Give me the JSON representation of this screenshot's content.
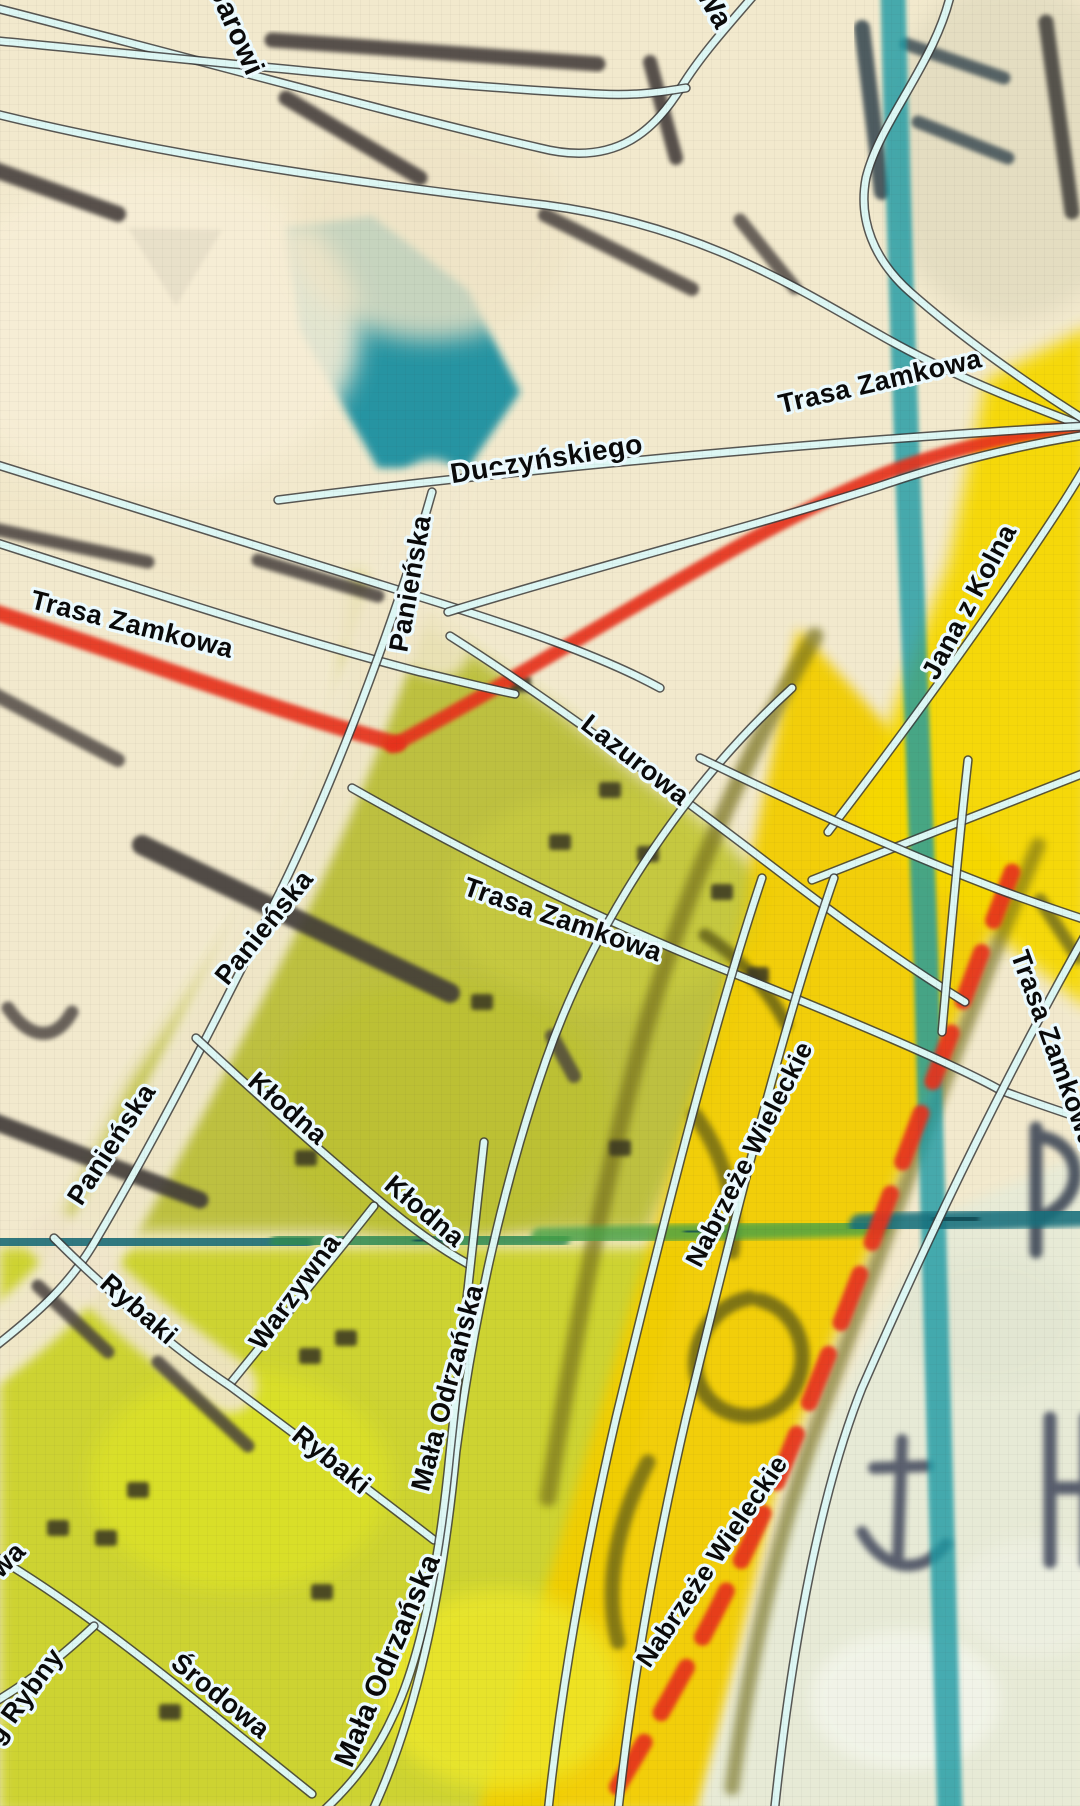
{
  "map": {
    "colors": {
      "background_cream": "#f2e9cd",
      "road_fill": "#ddf7f4",
      "road_casing": "#3c3c3c",
      "label_ink": "#0a0a0a",
      "label_halo": "#edfbff",
      "raster_red": "#e6301a",
      "raster_teal": "#1b9aa4",
      "raster_olive": "#b9bd36",
      "raster_yellow": "#f2cd02"
    },
    "street_labels": [
      {
        "text": "Jarowi",
        "x": 228,
        "y": 34,
        "rot": 66,
        "size": 29
      },
      {
        "text": "Wa",
        "x": 706,
        "y": 12,
        "rot": 60,
        "size": 29
      },
      {
        "text": "Trasa Zamkowa",
        "x": 882,
        "y": 390,
        "rot": -13,
        "size": 27
      },
      {
        "text": "Duczyńskiego",
        "x": 548,
        "y": 468,
        "rot": -9,
        "size": 28
      },
      {
        "text": "–",
        "x": 500,
        "y": 481,
        "rot": -6,
        "size": 28
      },
      {
        "text": "Panieńska",
        "x": 419,
        "y": 585,
        "rot": -80,
        "size": 27
      },
      {
        "text": "Trasa Zamkowa",
        "x": 130,
        "y": 633,
        "rot": 14,
        "size": 27
      },
      {
        "text": "Lazurowa",
        "x": 630,
        "y": 767,
        "rot": 38,
        "size": 27
      },
      {
        "text": "Jana z Kolna",
        "x": 977,
        "y": 606,
        "rot": -62,
        "size": 27
      },
      {
        "text": "Panieńska",
        "x": 271,
        "y": 933,
        "rot": -51,
        "size": 27
      },
      {
        "text": "Trasa Zamkowa",
        "x": 560,
        "y": 928,
        "rot": 19,
        "size": 27
      },
      {
        "text": "Nabrzeże Wieleckie",
        "x": 757,
        "y": 1158,
        "rot": -63,
        "size": 26
      },
      {
        "text": "Trasa Zamkowa",
        "x": 1046,
        "y": 1052,
        "rot": 70,
        "size": 27
      },
      {
        "text": "Panieńska",
        "x": 119,
        "y": 1149,
        "rot": -57,
        "size": 27
      },
      {
        "text": "Kłodna",
        "x": 282,
        "y": 1115,
        "rot": 41,
        "size": 27
      },
      {
        "text": "Kłodna",
        "x": 419,
        "y": 1218,
        "rot": 40,
        "size": 27
      },
      {
        "text": "Warzywna",
        "x": 302,
        "y": 1297,
        "rot": -54,
        "size": 27
      },
      {
        "text": "Rybaki",
        "x": 133,
        "y": 1316,
        "rot": 41,
        "size": 27
      },
      {
        "text": "Mała Odrzańska",
        "x": 456,
        "y": 1390,
        "rot": -75,
        "size": 27
      },
      {
        "text": "Rybaki",
        "x": 326,
        "y": 1467,
        "rot": 39,
        "size": 27
      },
      {
        "text": "wa",
        "x": 14,
        "y": 1566,
        "rot": -45,
        "size": 27
      },
      {
        "text": "Mała Odrzańska",
        "x": 396,
        "y": 1664,
        "rot": -67,
        "size": 29
      },
      {
        "text": "Nabrzeże Wieleckie",
        "x": 719,
        "y": 1566,
        "rot": -56,
        "size": 26
      },
      {
        "text": "Środowa",
        "x": 215,
        "y": 1703,
        "rot": 39,
        "size": 27
      },
      {
        "text": "g Rybny",
        "x": 32,
        "y": 1701,
        "rot": -54,
        "size": 27
      }
    ],
    "roads": [
      {
        "name": "jarowita-loop",
        "d": "M -12,6 C 180,55 400,116 540,148 C 618,168 656,128 682,86 C 703,52 733,20 760,-12"
      },
      {
        "name": "coastal-upper",
        "d": "M -12,40 C 200,60 420,85 600,94 C 635,96 662,92 686,88"
      },
      {
        "name": "northeast-diagonal",
        "d": "M -12,112 C 180,160 380,185 545,205 C 700,225 800,290 880,335 C 950,375 1020,402 1088,428"
      },
      {
        "name": "harbor-curve",
        "d": "M 952,-12 C 938,60 880,120 866,178 C 858,220 874,260 910,292 C 960,336 1024,382 1088,422"
      },
      {
        "name": "duczynskiego",
        "d": "M 278,500 C 450,478 650,458 850,442 C 930,436 1010,430 1088,426"
      },
      {
        "name": "trasa-zamkowa-west-upper",
        "d": "M -12,462 C 150,512 300,558 430,600 C 510,625 600,655 660,688"
      },
      {
        "name": "trasa-zamkowa-west-lower",
        "d": "M -12,540 C 150,592 290,638 420,672 C 455,680 485,688 515,694"
      },
      {
        "name": "trasa-zamkowa-main",
        "d": "M 448,612 C 600,565 760,525 880,486 C 950,462 1020,445 1092,434"
      },
      {
        "name": "panienska",
        "d": "M 432,492 C 402,598 345,758 282,888 C 232,988 162,1128 97,1238 C 72,1282 40,1312 -12,1352"
      },
      {
        "name": "lazurowa",
        "d": "M 450,636 C 560,706 680,796 790,880 C 850,926 910,968 965,1002"
      },
      {
        "name": "trasa-zamkowa-central",
        "d": "M 352,788 C 470,855 600,920 720,968 C 830,1012 950,1062 1000,1090 C 1032,1102 1062,1112 1092,1122"
      },
      {
        "name": "ring-curve",
        "d": "M 792,688 C 680,790 592,928 546,1060 C 500,1192 472,1330 456,1452 C 442,1600 414,1722 372,1812"
      },
      {
        "name": "jana-z-kolna",
        "d": "M 828,832 C 900,738 980,628 1040,538 C 1056,514 1072,490 1088,462"
      },
      {
        "name": "interchange-ramp-1",
        "d": "M 812,880 L 1092,770"
      },
      {
        "name": "interchange-ramp-2",
        "d": "M 700,758 C 800,806 900,852 1000,890 C 1032,902 1062,912 1092,922"
      },
      {
        "name": "interchange-ramp-3",
        "d": "M 968,760 C 958,850 950,940 942,1032"
      },
      {
        "name": "nabrzeze-wieleckie-west",
        "d": "M 762,878 C 712,1028 662,1228 616,1418 C 586,1548 562,1678 548,1812"
      },
      {
        "name": "nabrzeze-wieleckie-east",
        "d": "M 834,878 C 782,1028 732,1228 686,1418 C 656,1548 632,1678 618,1812"
      },
      {
        "name": "trasa-zamkowa-east",
        "d": "M 1088,930 C 1010,1068 932,1228 862,1388 C 822,1488 792,1640 774,1815"
      },
      {
        "name": "klodna",
        "d": "M 196,1038 C 252,1090 312,1144 376,1198 C 404,1222 436,1246 468,1264"
      },
      {
        "name": "warzywna",
        "d": "M 230,1384 C 280,1322 330,1262 374,1206"
      },
      {
        "name": "rybaki",
        "d": "M 54,1238 C 112,1296 176,1350 230,1386 C 300,1438 372,1492 434,1540"
      },
      {
        "name": "mala-odrzanska",
        "d": "M 484,1142 C 470,1262 460,1360 450,1452 C 440,1556 422,1658 392,1718 C 372,1762 344,1792 320,1814"
      },
      {
        "name": "srodowa",
        "d": "M -12,1552 C 60,1594 130,1648 200,1704 C 242,1738 280,1768 312,1794"
      },
      {
        "name": "targ-rybny",
        "d": "M 94,1626 C 62,1656 30,1682 -12,1706"
      }
    ],
    "red_roads": [
      {
        "d": "M -12,610 C 150,662 290,716 398,744",
        "w": 16
      },
      {
        "d": "M 392,746 C 560,656 762,520 900,468 C 966,445 1026,432 1090,426",
        "w": 14
      },
      {
        "d": "M 1012,872 C 940,1060 868,1260 790,1450 C 744,1566 672,1700 602,1812",
        "w": 17,
        "dash": "52 34"
      }
    ],
    "raster": {
      "zones": [
        {
          "points": "352,572 560,712 770,886 706,1105 648,1232 58,1232 132,1082 262,892 342,702",
          "fill": "#b9bd36",
          "blur": 8,
          "op": 0.92
        },
        {
          "points": "0,1248 688,1248 636,1442 556,1812 0,1812",
          "fill": "#ccd22b",
          "blur": 6,
          "op": 0.95
        },
        {
          "points": "798,628 1016,868 898,1180 778,1480 700,1812 478,1812 618,1350 722,1000",
          "fill": "#f2cd02",
          "blur": 6,
          "op": 0.95
        },
        {
          "points": "986,380 1090,326 1090,1010 852,822 948,564",
          "fill": "#f6d802",
          "blur": 8,
          "op": 0.95
        },
        {
          "points": "938,1216 1090,1150 1090,1812 698,1812 788,1500 878,1322",
          "fill": "#e7ebd7",
          "blur": 6,
          "op": 0.97
        },
        {
          "points": "128,228 222,230 176,306",
          "fill": "#57524c",
          "blur": 2,
          "op": 0.9
        },
        {
          "points": "286,228 372,216 468,290 520,392 468,468 378,468 300,330",
          "fill": "#1d90a0",
          "blur": 4,
          "op": 0.95
        }
      ],
      "patches": [
        {
          "cx": 150,
          "cy": 330,
          "rx": 210,
          "ry": 160,
          "fill": "#f7eed6",
          "blur": 12,
          "op": 0.9
        },
        {
          "cx": 430,
          "cy": 230,
          "rx": 140,
          "ry": 110,
          "fill": "#efe4c6",
          "blur": 12,
          "op": 0.8
        },
        {
          "cx": 600,
          "cy": 900,
          "rx": 150,
          "ry": 110,
          "fill": "#c8cb40",
          "blur": 10,
          "op": 0.8
        },
        {
          "cx": 440,
          "cy": 1110,
          "rx": 170,
          "ry": 130,
          "fill": "#bcc133",
          "blur": 10,
          "op": 0.85
        },
        {
          "cx": 240,
          "cy": 1480,
          "rx": 150,
          "ry": 110,
          "fill": "#dde226",
          "blur": 10,
          "op": 0.8
        },
        {
          "cx": 500,
          "cy": 1690,
          "rx": 120,
          "ry": 100,
          "fill": "#eee82a",
          "blur": 10,
          "op": 0.8
        },
        {
          "cx": 1010,
          "cy": 150,
          "rx": 130,
          "ry": 170,
          "fill": "#e2dbc0",
          "blur": 10,
          "op": 0.85
        },
        {
          "cx": 905,
          "cy": 1700,
          "rx": 95,
          "ry": 70,
          "fill": "#f3f5ea",
          "blur": 8,
          "op": 0.9
        },
        {
          "cx": 1035,
          "cy": 1598,
          "rx": 80,
          "ry": 60,
          "fill": "#eef0e2",
          "blur": 8,
          "op": 0.85
        },
        {
          "cx": 990,
          "cy": 1320,
          "rx": 90,
          "ry": 70,
          "fill": "#e2e6d2",
          "blur": 8,
          "op": 0.8
        }
      ],
      "strokes": [
        {
          "d": "M 432,492 C 402,598 345,758 282,888 C 232,988 162,1128 97,1238 C 72,1282 40,1312 -12,1352",
          "stroke": "#f2e9cf",
          "w": 66,
          "blur": 5,
          "op": 0.95
        },
        {
          "d": "M 54,1238 C 112,1296 176,1350 230,1386",
          "stroke": "#f0e5cb",
          "w": 54,
          "blur": 5,
          "op": 0.9
        },
        {
          "d": "M -12,505 C 150,555 300,600 440,648",
          "stroke": "#f1e7c9",
          "w": 60,
          "blur": 6,
          "op": 0.85
        },
        {
          "d": "M -10,168 L 118,214",
          "stroke": "#46413c",
          "w": 16,
          "blur": 2,
          "op": 0.9
        },
        {
          "d": "M 272,40 L 598,64",
          "stroke": "#46413c",
          "w": 15,
          "blur": 2,
          "op": 0.9
        },
        {
          "d": "M 286,98 L 420,178",
          "stroke": "#46413c",
          "w": 15,
          "blur": 2,
          "op": 0.9
        },
        {
          "d": "M 650,62 L 676,158",
          "stroke": "#46413c",
          "w": 14,
          "blur": 2,
          "op": 0.9
        },
        {
          "d": "M 545,215 L 692,289",
          "stroke": "#46413c",
          "w": 14,
          "blur": 2,
          "op": 0.85
        },
        {
          "d": "M 740,220 L 795,288",
          "stroke": "#46413c",
          "w": 13,
          "blur": 2,
          "op": 0.8
        },
        {
          "d": "M 862,28 L 882,192",
          "stroke": "#3e4e54",
          "w": 16,
          "blur": 2,
          "op": 0.9
        },
        {
          "d": "M 906,44 L 1004,78",
          "stroke": "#3e4e54",
          "w": 13,
          "blur": 2,
          "op": 0.85
        },
        {
          "d": "M 918,122 L 1008,158",
          "stroke": "#3e4e54",
          "w": 13,
          "blur": 2,
          "op": 0.85
        },
        {
          "d": "M 1046,22 L 1072,212",
          "stroke": "#474541",
          "w": 15,
          "blur": 2,
          "op": 0.9
        },
        {
          "d": "M -10,528 L 148,562",
          "stroke": "#46413c",
          "w": 13,
          "blur": 2,
          "op": 0.85
        },
        {
          "d": "M 258,560 L 378,596",
          "stroke": "#46413c",
          "w": 13,
          "blur": 2,
          "op": 0.85
        },
        {
          "d": "M 142,845 L 450,993",
          "stroke": "#3f3a38",
          "w": 20,
          "blur": 2,
          "op": 0.9
        },
        {
          "d": "M -10,692 L 118,760",
          "stroke": "#46413c",
          "w": 14,
          "blur": 2,
          "op": 0.8
        },
        {
          "d": "M -10,1120 L 200,1200",
          "stroke": "#3f3a38",
          "w": 17,
          "blur": 2,
          "op": 0.9
        },
        {
          "d": "M 38,1286 L 108,1352",
          "stroke": "#46413c",
          "w": 13,
          "blur": 2,
          "op": 0.85
        },
        {
          "d": "M 158,1362 L 248,1446",
          "stroke": "#46413c",
          "w": 13,
          "blur": 2,
          "op": 0.85
        },
        {
          "d": "M 8,1008 C 30,1040 55,1042 72,1012",
          "stroke": "#46413c",
          "w": 13,
          "blur": 2,
          "op": 0.8
        },
        {
          "d": "M 552,1036 L 574,1076",
          "stroke": "#46413c",
          "w": 14,
          "blur": 2,
          "op": 0.8
        },
        {
          "d": "M 815,636 C 742,760 682,898 642,1040 C 602,1188 572,1348 548,1498",
          "stroke": "#77711a",
          "w": 17,
          "blur": 4,
          "op": 0.7
        },
        {
          "d": "M 1038,845 C 962,1030 892,1220 822,1410 C 782,1520 752,1640 732,1788",
          "stroke": "#6f6a16",
          "w": 15,
          "blur": 4,
          "op": 0.6
        },
        {
          "d": "M 760,1300 C 800,1310 815,1360 790,1395 C 765,1428 715,1420 700,1385 C 685,1350 710,1305 750,1298",
          "stroke": "#6b6514",
          "w": 15,
          "blur": 3,
          "op": 0.85
        },
        {
          "d": "M 695,1115 C 722,1152 738,1200 732,1252",
          "stroke": "#6b6514",
          "w": 15,
          "blur": 3,
          "op": 0.8
        },
        {
          "d": "M 648,1462 C 616,1524 604,1588 618,1642",
          "stroke": "#6b6514",
          "w": 15,
          "blur": 3,
          "op": 0.8
        },
        {
          "d": "M 705,935 C 740,958 770,992 786,1024",
          "stroke": "#5f5c12",
          "w": 13,
          "blur": 3,
          "op": 0.8
        },
        {
          "d": "M 1040,900 L 1078,958",
          "stroke": "#5a5a20",
          "w": 13,
          "blur": 3,
          "op": 0.7
        },
        {
          "d": "M 902,1440 L 898,1556 M 862,1532 C 884,1572 922,1576 946,1544 M 874,1468 L 928,1466",
          "stroke": "#4b5164",
          "w": 12,
          "blur": 3,
          "op": 0.9
        },
        {
          "d": "M 1050,1418 L 1050,1562 M 1050,1488 L 1086,1488 M 1086,1418 L 1086,1562",
          "stroke": "#495062",
          "w": 13,
          "blur": 3,
          "op": 0.9
        },
        {
          "d": "M 1036,1128 L 1036,1252 M 1036,1136 C 1082,1140 1092,1196 1040,1218",
          "stroke": "#3f4a58",
          "w": 13,
          "blur": 3,
          "op": 0.9
        },
        {
          "d": "M 893,-12 C 900,300 914,640 926,960 C 936,1230 944,1520 950,1816",
          "stroke": "#1b9aa4",
          "w": 25,
          "blur": 2,
          "op": 0.8
        },
        {
          "d": "M -12,1240 L 300,1244",
          "stroke": "#1d6d78",
          "w": 24,
          "blur": 3,
          "op": 0.9
        },
        {
          "d": "M 280,1243 L 560,1238",
          "stroke": "#2f8a52",
          "w": 20,
          "blur": 3,
          "op": 0.85
        },
        {
          "d": "M 540,1237 L 880,1227",
          "stroke": "#44a047",
          "w": 18,
          "blur": 3,
          "op": 0.8
        },
        {
          "d": "M 860,1225 L 1092,1215",
          "stroke": "#15707d",
          "w": 22,
          "blur": 3,
          "op": 0.88
        },
        {
          "d": "M 80,1240 L 112,1240",
          "stroke": "#0d4a52",
          "w": 16,
          "blur": 2,
          "op": 0.9
        },
        {
          "d": "M 420,1241 L 452,1240",
          "stroke": "#0d4a52",
          "w": 14,
          "blur": 2,
          "op": 0.85
        },
        {
          "d": "M 690,1232 L 718,1231",
          "stroke": "#0d4a52",
          "w": 13,
          "blur": 2,
          "op": 0.8
        },
        {
          "d": "M 940,1220 L 972,1218",
          "stroke": "#0d4a52",
          "w": 15,
          "blur": 2,
          "op": 0.85
        }
      ],
      "dots": [
        {
          "x": 610,
          "y": 790
        },
        {
          "x": 722,
          "y": 892
        },
        {
          "x": 520,
          "y": 684
        },
        {
          "x": 482,
          "y": 1002
        },
        {
          "x": 306,
          "y": 1158
        },
        {
          "x": 346,
          "y": 1338
        },
        {
          "x": 138,
          "y": 1490
        },
        {
          "x": 58,
          "y": 1528
        },
        {
          "x": 106,
          "y": 1538
        },
        {
          "x": 170,
          "y": 1712
        },
        {
          "x": 758,
          "y": 975
        },
        {
          "x": 620,
          "y": 1148
        },
        {
          "x": 310,
          "y": 1356
        },
        {
          "x": 560,
          "y": 842
        },
        {
          "x": 648,
          "y": 854
        },
        {
          "x": 322,
          "y": 1592
        }
      ]
    }
  }
}
